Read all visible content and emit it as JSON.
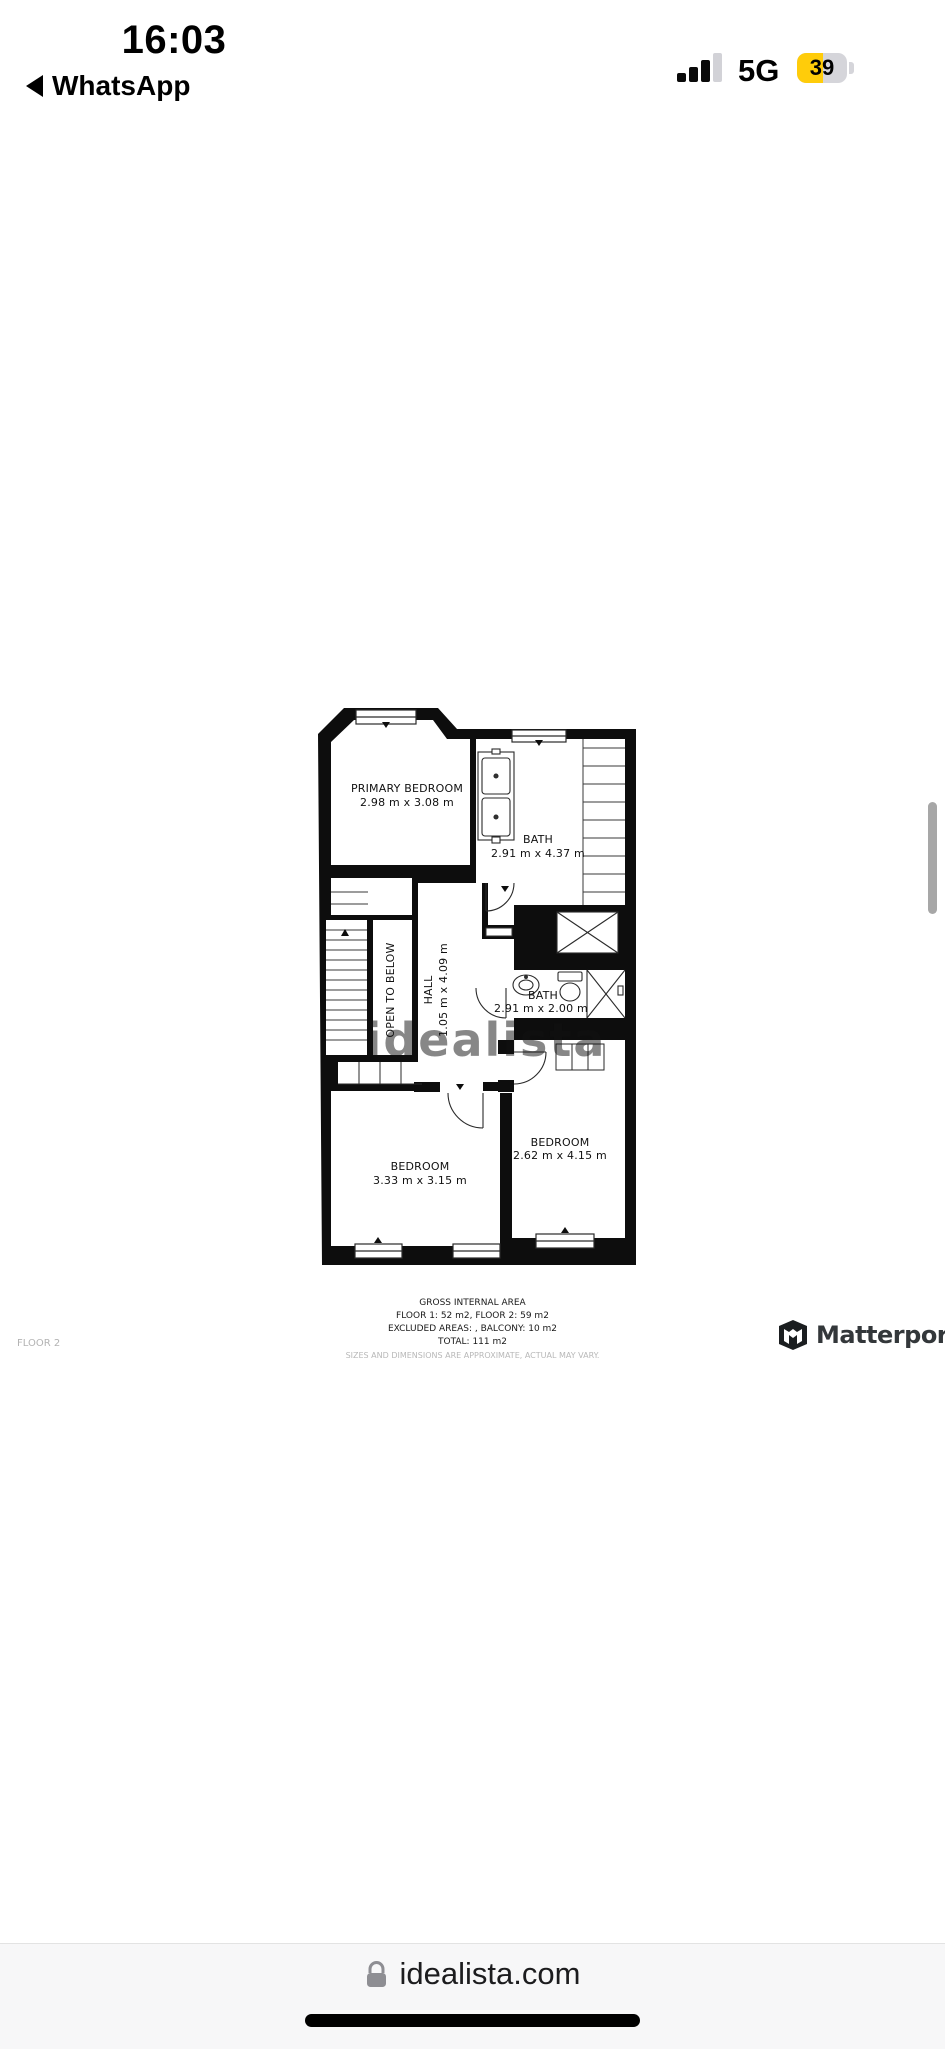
{
  "status_bar": {
    "time": "16:03",
    "back_label": "WhatsApp",
    "network": "5G",
    "battery_percent": "39",
    "battery_color": "#FFCC0A"
  },
  "floor_plan": {
    "watermark": "idealista",
    "rooms": {
      "primary_bedroom": {
        "label": "PRIMARY BEDROOM",
        "dims": "2.98 m x 3.08 m"
      },
      "bath_top": {
        "label": "BATH",
        "dims": "2.91 m x 4.37 m"
      },
      "hall": {
        "label": "HALL",
        "dims": "1.05 m x 4.09 m"
      },
      "open_to_below": {
        "label": "OPEN TO BELOW"
      },
      "bath_mid": {
        "label": "BATH",
        "dims": "2.91 m x 2.00 m"
      },
      "bedroom_left": {
        "label": "BEDROOM",
        "dims": "3.33 m x 3.15 m"
      },
      "bedroom_right": {
        "label": "BEDROOM",
        "dims": "2.62 m x 4.15 m"
      }
    },
    "summary": {
      "title": "GROSS INTERNAL AREA",
      "line1": "FLOOR 1: 52 m2, FLOOR 2: 59 m2",
      "line2": "EXCLUDED AREAS: , BALCONY: 10 m2",
      "line3": "TOTAL: 111 m2",
      "disclaimer": "SIZES AND DIMENSIONS ARE APPROXIMATE, ACTUAL MAY VARY."
    },
    "floor_label": "FLOOR 2",
    "brand": "Matterport"
  },
  "browser": {
    "url": "idealista.com"
  }
}
